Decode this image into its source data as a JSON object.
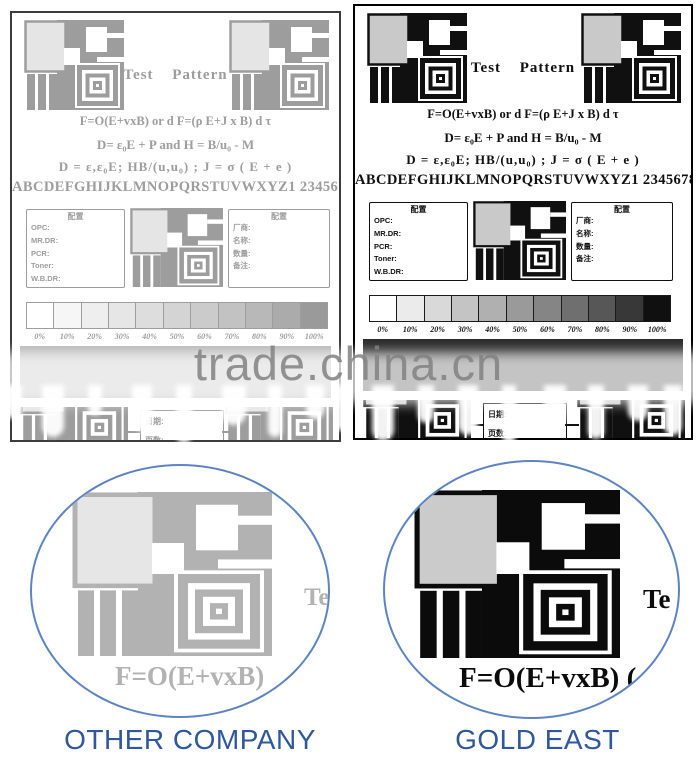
{
  "watermark": {
    "text": "trade.china.cn"
  },
  "page": {
    "title": "Test Pattern",
    "formula1": "F=O(E+vxB) or d F=(ρ E+J x B) d  τ",
    "formula2": "D= ε₀E + P   and   H = B/u₀ - M",
    "formula3": "D = ε,ε₀E; HB/(u,u₀) ; J = σ ( E + e )",
    "alphabet": "ABCDEFGHIJKLMNOPQRSTUVWXYZ1 234567890",
    "config_box": {
      "header": "配置",
      "rows": [
        "OPC:",
        "MR.DR:",
        "PCR:",
        "Toner:",
        "W.B.DR:"
      ]
    },
    "info_box": {
      "header": "配置",
      "rows": [
        "厂商:",
        "名称:",
        "数量:",
        "备注:"
      ]
    },
    "grayscale_labels": [
      "0%",
      "10%",
      "20%",
      "30%",
      "40%",
      "50%",
      "60%",
      "70%",
      "80%",
      "90%",
      "100%"
    ],
    "footer_box": {
      "row1": "日期:",
      "row2": "页数:"
    }
  },
  "insets": {
    "left": {
      "partial_text": "Te",
      "formula": "F=O(E+vxB)"
    },
    "right": {
      "partial_text": "Te",
      "formula": "F=O(E+vxB) ("
    }
  },
  "captions": {
    "left": "OTHER COMPANY",
    "right": "GOLD EAST"
  },
  "colors": {
    "caption_blue": "#2E579D",
    "ellipse_stroke": "#5C84C4",
    "faded_ink": "#9D9D9D",
    "crisp_ink": "#101010"
  }
}
